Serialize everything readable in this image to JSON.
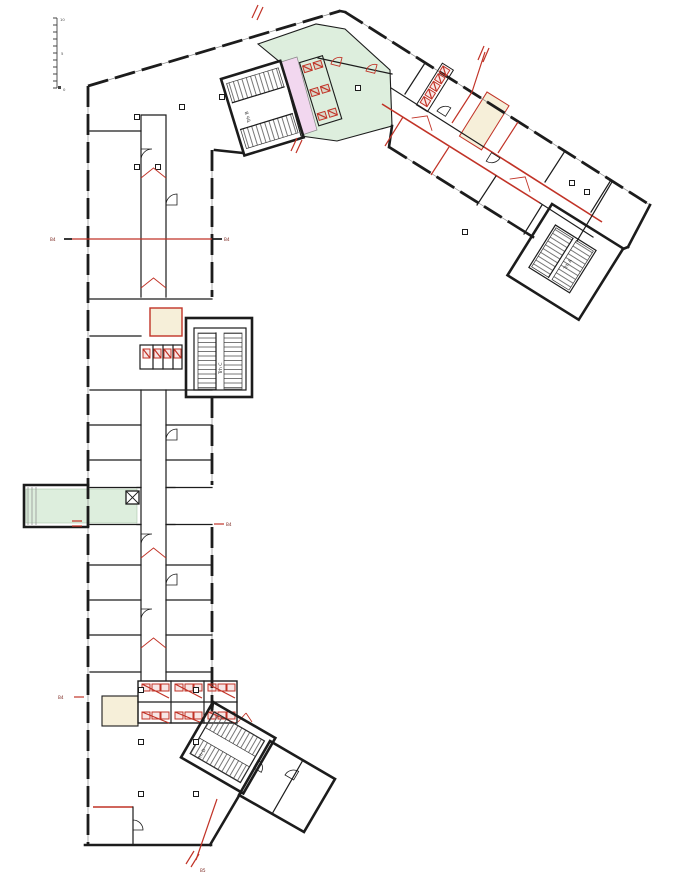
{
  "drawing": {
    "title": "floor-plan",
    "labels": {
      "stair_a": "Trh A",
      "stair_b": "Trh B",
      "stair_c": "Trh C",
      "stair_d": "Trh D"
    },
    "section_markers": {
      "left_b4": "B4",
      "right_b4": "B4",
      "mid_b4": "B4",
      "low_b4": "B4",
      "bottom_b5": "B5"
    },
    "scale_bar": {
      "top": "10",
      "mid": "5",
      "bottom": "0"
    },
    "colors": {
      "wall": "#1c1c1c",
      "red": "#c13327",
      "green": "#ddeedd",
      "pink": "#f2d7ef",
      "beige": "#f6efd9",
      "hatch": "#555555"
    }
  }
}
